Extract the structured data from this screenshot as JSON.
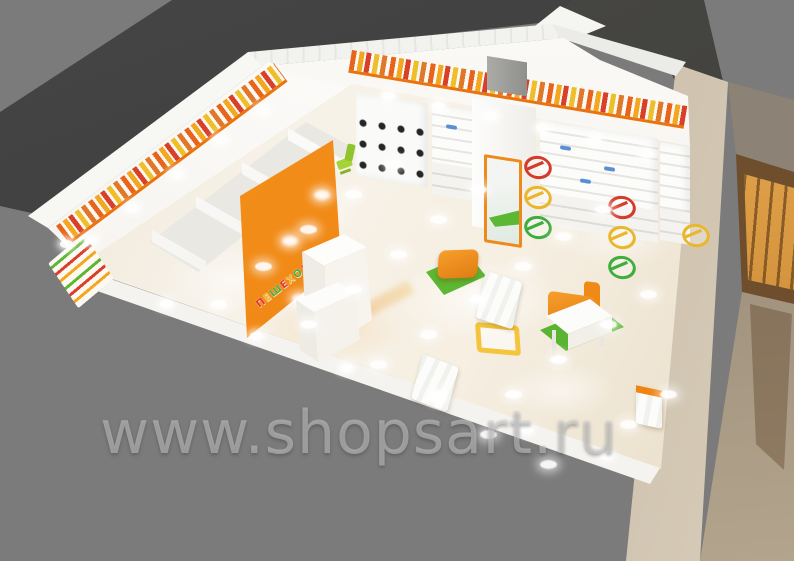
{
  "watermark": {
    "text": "www.shopsart.ru"
  },
  "scene": {
    "description": "3D interior visualization of a children's shoe store in a shopping mall",
    "store_sign": {
      "letters": [
        {
          "char": "П",
          "color": "#e03a2f"
        },
        {
          "char": "Е",
          "color": "#f0b42c"
        },
        {
          "char": "Ш",
          "color": "#4caf3e"
        },
        {
          "char": "Е",
          "color": "#e03a2f"
        },
        {
          "char": "Х",
          "color": "#f0b42c"
        },
        {
          "char": "О",
          "color": "#4caf3e"
        },
        {
          "char": "Д",
          "color": "#e03a2f"
        },
        {
          "char": "И",
          "color": "#f0b42c"
        },
        {
          "char": "К",
          "color": "#4caf3e"
        },
        {
          "char": "И",
          "color": "#e03a2f"
        }
      ]
    },
    "traffic_rings": {
      "colors": [
        "#d63a2a",
        "#eab72c",
        "#3fae3c"
      ]
    },
    "palette": {
      "accent_orange": "#f0861a",
      "rug_green": "#5cb732",
      "floor_cream": "#f4eee2",
      "background_gray": "#7b7b7b",
      "ceiling_dark": "#3e3e3e",
      "mall_warm": "#d29035",
      "shoe_blue": "#5b8fd4"
    }
  }
}
